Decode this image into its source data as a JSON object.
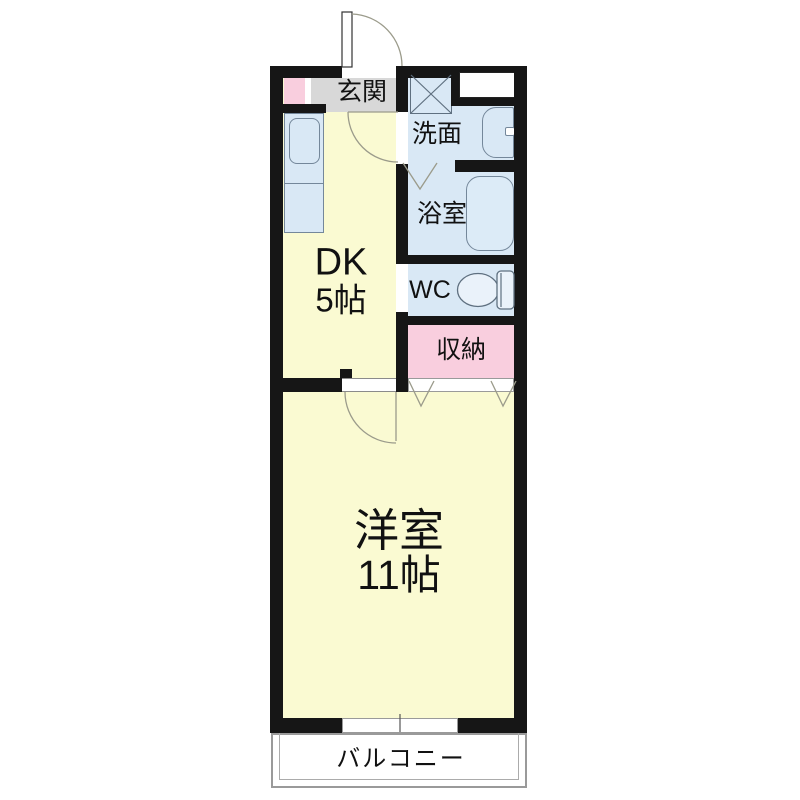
{
  "plan": {
    "rooms": {
      "genkan": {
        "label": "玄関"
      },
      "washroom": {
        "label": "洗面"
      },
      "bathroom": {
        "label": "浴室"
      },
      "wc": {
        "label": "WC"
      },
      "storage": {
        "label": "収納"
      },
      "dk": {
        "label": "DK",
        "size": "5帖"
      },
      "western": {
        "label": "洋室",
        "size": "11帖"
      },
      "balcony": {
        "label": "バルコニー"
      }
    },
    "colors": {
      "wall": "#161616",
      "room_yellow": "#fafad2",
      "wet_area_blue": "#d9e8f5",
      "storage_pink": "#f9cede",
      "genkan_gray": "#d8d8d8",
      "fixture_outline": "#74879a",
      "door_swing": "#9b9b8b"
    }
  }
}
